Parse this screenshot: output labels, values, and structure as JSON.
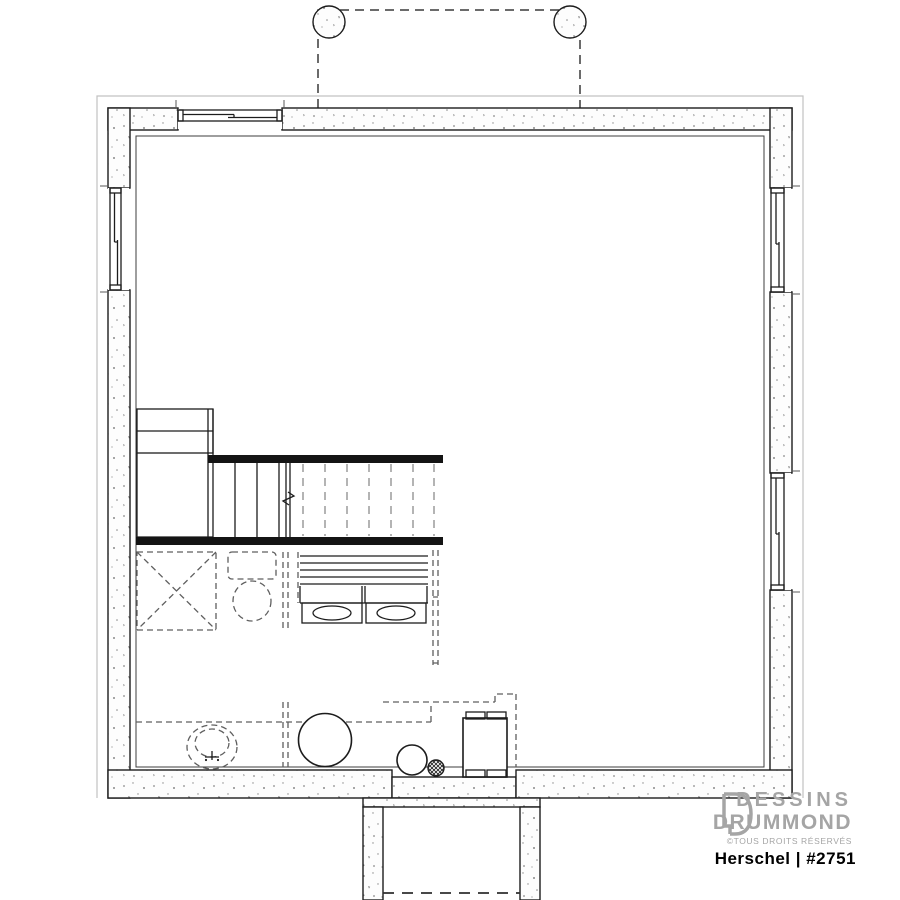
{
  "page": {
    "background": "#ffffff",
    "width": 900,
    "height": 900
  },
  "colors": {
    "line": "#1c1c1c",
    "dashed": "#5f5f5f",
    "tread": "#9c9c9c",
    "bar": "#141414",
    "footing": "#c2c2c2",
    "concrete": "#fdfdfd",
    "speckle": "#8a8a8a",
    "logo_gray": "#a5a5a5",
    "title_black": "#000000"
  },
  "branding": {
    "studio_line1": "DESSINS",
    "studio_line2": "DRUMMOND",
    "rights_notice": "©TOUS DROITS RÉSERVÉS",
    "logo_icon": "drummond-d-monogram"
  },
  "title_block": {
    "plan_title": "Herschel | #2751"
  },
  "drawing": {
    "type": "basement-foundation-plan",
    "fixtures": [
      "porch-post-left",
      "porch-post-right",
      "window-top",
      "window-left",
      "window-right-upper",
      "window-right-lower",
      "staircase",
      "half-wall-upper",
      "half-wall-lower",
      "storage-shelves",
      "future-shower",
      "future-toilet",
      "future-wall",
      "vanity-double-sink",
      "laundry-tub",
      "water-heater",
      "pressure-tank",
      "floor-drain",
      "furnace",
      "cold-room"
    ]
  }
}
